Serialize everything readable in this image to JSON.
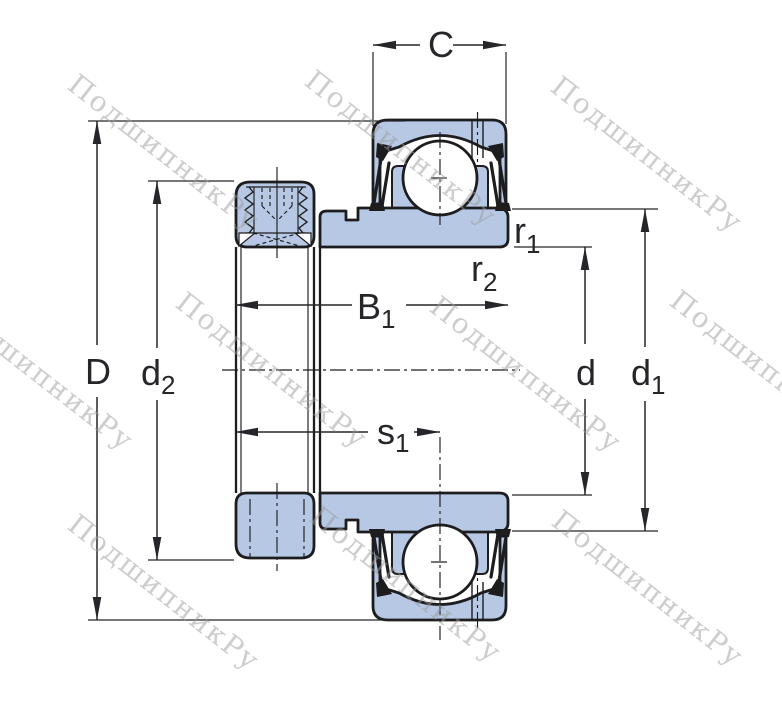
{
  "drawing": {
    "kind": "insert ball bearing with eccentric locking collar, sectional dimension drawing"
  },
  "watermark": {
    "text": "ПодшипникРу"
  },
  "labels": {
    "C": {
      "main": "C"
    },
    "D": {
      "main": "D"
    },
    "d2": {
      "main": "d",
      "sub": "2"
    },
    "B1": {
      "main": "B",
      "sub": "1"
    },
    "s1": {
      "main": "s",
      "sub": "1"
    },
    "r1": {
      "main": "r",
      "sub": "1"
    },
    "r2": {
      "main": "r",
      "sub": "2"
    },
    "d": {
      "main": "d"
    },
    "d1": {
      "main": "d",
      "sub": "1"
    }
  },
  "colors": {
    "part_fill": "#b6c8e4",
    "outline": "#1d1d1f",
    "dimension": "#26262a",
    "watermark": "#9c9c9c",
    "background": "#ffffff"
  }
}
